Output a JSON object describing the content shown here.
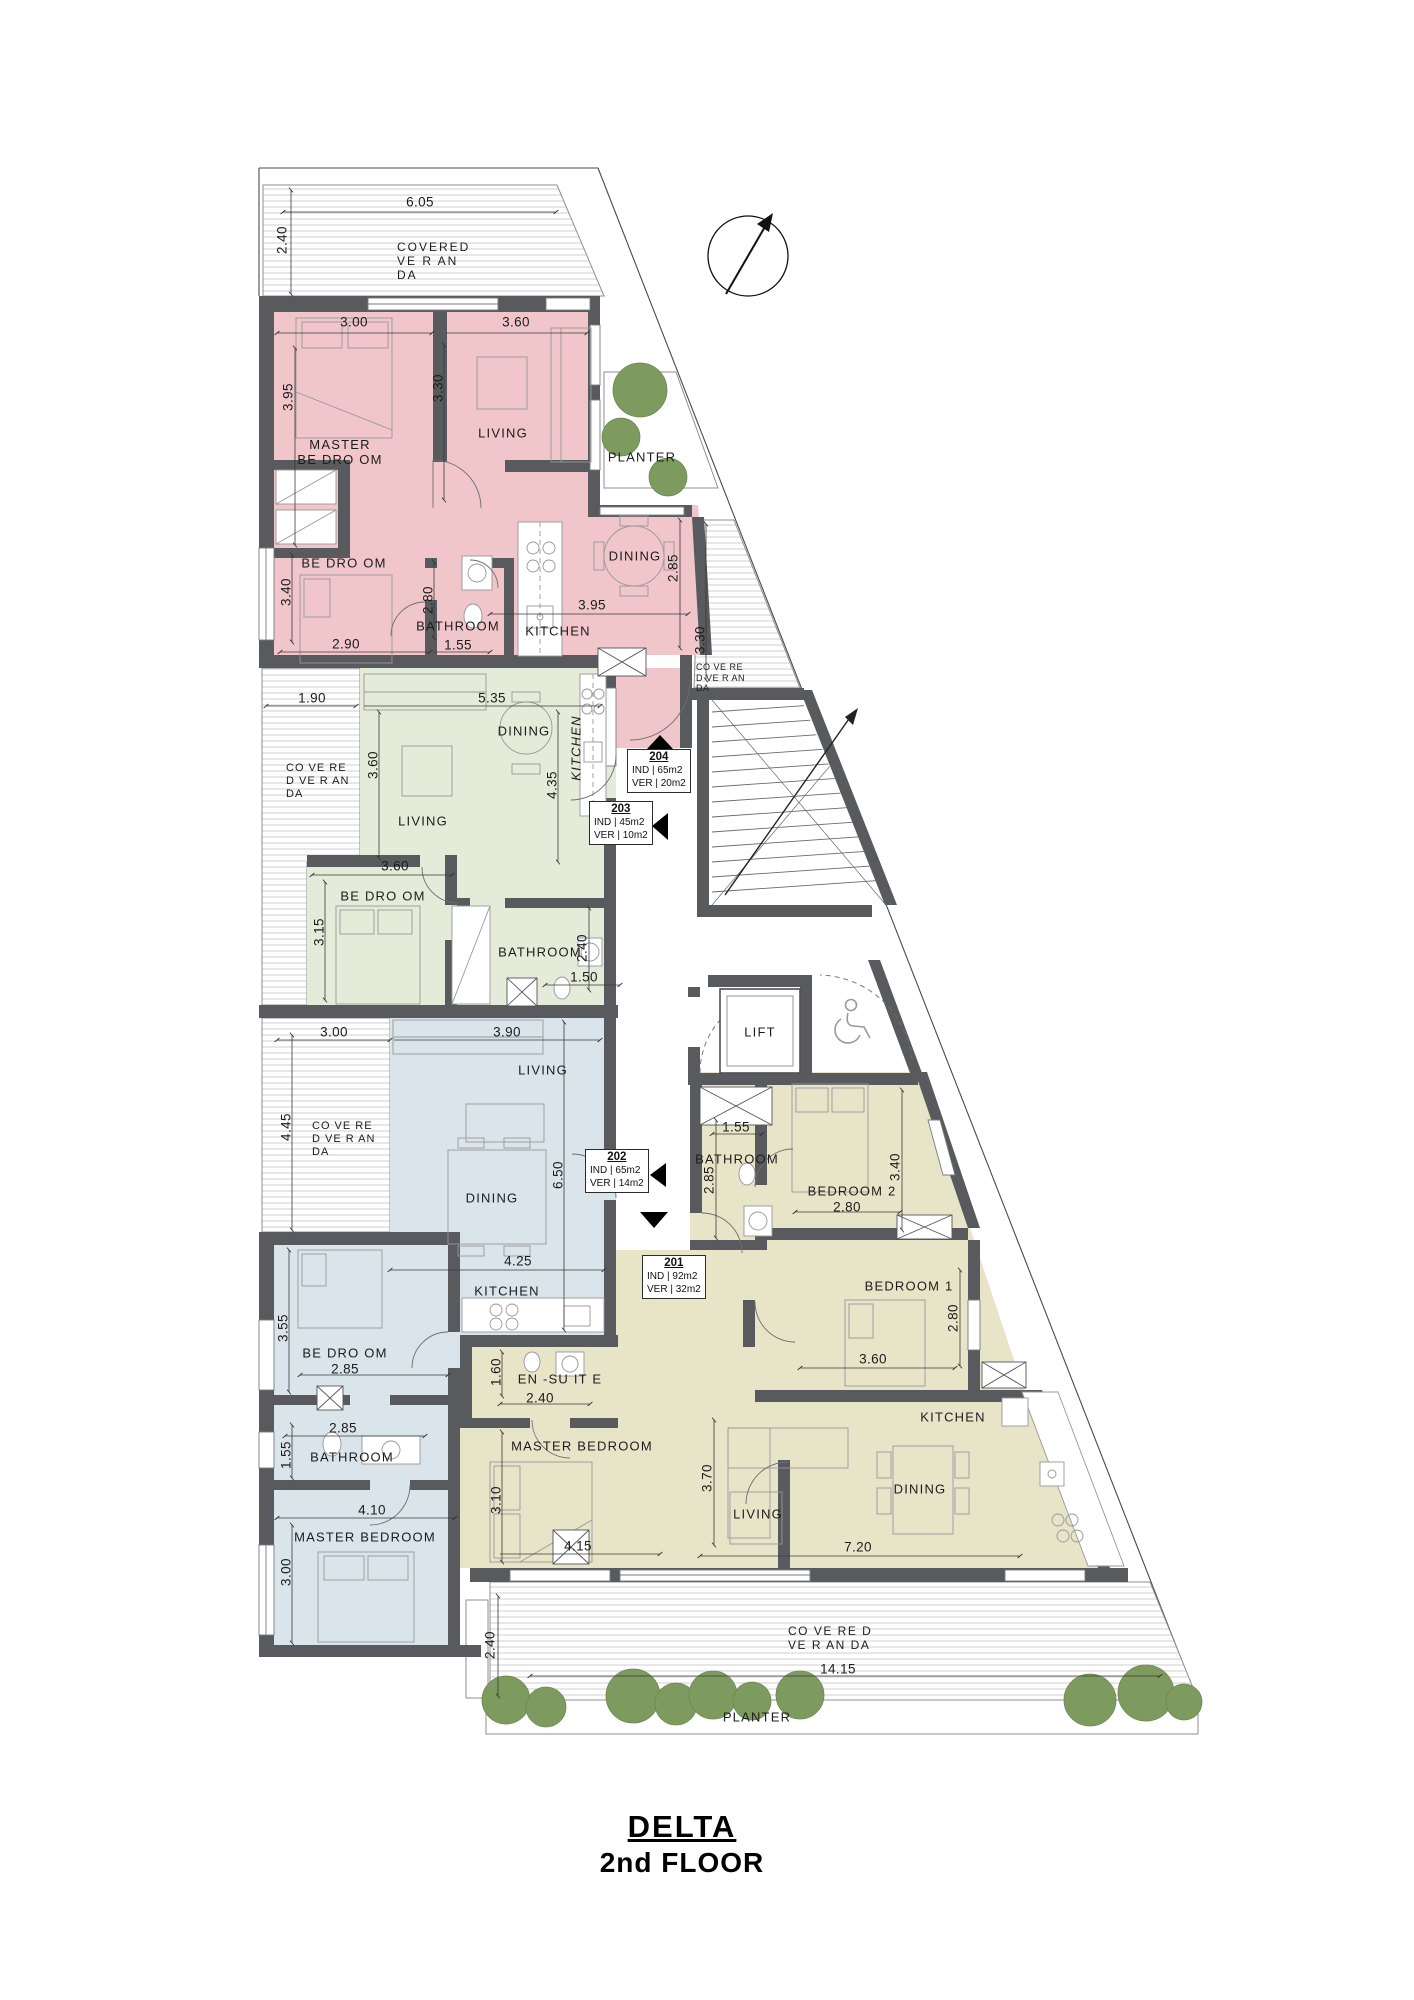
{
  "title": {
    "project": "DELTA",
    "floor": "2nd FLOOR"
  },
  "site": {
    "veranda_top": {
      "l1": "COVERED",
      "l2": "VE  R  AN",
      "l3": "DA",
      "width": "6.05",
      "depth": "2.40"
    },
    "veranda_right": {
      "l1": "CO VE RE",
      "l2": "D VE R AN",
      "l3": "DA",
      "depth": "3.30"
    },
    "veranda_bottom": {
      "l1": "CO VE RE D",
      "l2": "VE R AN DA",
      "width": "14.15",
      "depth": "2.40"
    },
    "planter_top": "PLANTER",
    "planter_bottom": "PLANTER",
    "lift": "LIFT"
  },
  "u204": {
    "number": "204",
    "ind": "IND | 65m2",
    "ver": "VER | 20m2",
    "master_l1": "MASTER",
    "master_l2": "BE DRO OM",
    "living": "LIVING",
    "bedroom": "BE DRO OM",
    "bathroom": "BATHROOM",
    "kitchen": "KITCHEN",
    "dining": "DINING",
    "dims": {
      "master_w": "3.00",
      "living_w": "3.60",
      "master_h": "3.95",
      "living_h": "3.30",
      "bedroom_h": "3.40",
      "bedroom_w": "2.90",
      "bath_h": "2.80",
      "bath_w": "1.55",
      "kitchen_w": "3.95",
      "dining_h": "2.85"
    }
  },
  "u203": {
    "number": "203",
    "ind": "IND | 45m2",
    "ver": "VER | 10m2",
    "veranda_l1": "CO  VE  RE",
    "veranda_l2": "D VE R AN",
    "veranda_l3": "DA",
    "living": "LIVING",
    "dining": "DINING",
    "kitchen": "KITCHEN",
    "bedroom": "BE DRO OM",
    "bathroom": "BATHROOM",
    "dims": {
      "veranda_w": "1.90",
      "living_w": "5.35",
      "living_h": "3.60",
      "kitchen_h": "4.35",
      "bedroom_w": "3.60",
      "bedroom_h": "3.15",
      "bath_h": "2.40",
      "bath_w": "1.50"
    }
  },
  "u202": {
    "number": "202",
    "ind": "IND | 65m2",
    "ver": "VER | 14m2",
    "veranda_l1": "CO  VE  RE",
    "veranda_l2": "D VE R AN",
    "veranda_l3": "DA",
    "living": "LIVING",
    "dining": "DINING",
    "kitchen": "KITCHEN",
    "bedroom": "BE DRO OM",
    "bathroom": "BATHROOM",
    "master": "MASTER BEDROOM",
    "dims": {
      "veranda_w": "3.00",
      "living_w": "3.90",
      "veranda_h": "4.45",
      "dining_h": "6.50",
      "kitchen_w": "4.25",
      "bedroom_h": "3.55",
      "bedroom_w": "2.85",
      "hall_w": "2.85",
      "bath_h": "1.55",
      "master_w": "4.10",
      "master_h": "3.00"
    }
  },
  "u201": {
    "number": "201",
    "ind": "IND | 92m2",
    "ver": "VER | 32m2",
    "bedroom2": "BEDROOM 2",
    "bedroom1": "BEDROOM 1",
    "bathroom": "BATHROOM",
    "ensuite": "EN -SU IT E",
    "master": "MASTER BEDROOM",
    "living": "LIVING",
    "dining": "DINING",
    "kitchen": "KITCHEN",
    "dims": {
      "bath_w": "1.55",
      "bath_h": "2.85",
      "bedroom2_w": "2.80",
      "bedroom2_h": "3.40",
      "bedroom1_h": "2.80",
      "bedroom1_w": "3.60",
      "ensuite_w": "2.40",
      "ensuite_h": "1.60",
      "master_w": "4.15",
      "master_h": "3.10",
      "living_h": "3.70",
      "dining_w": "7.20"
    }
  },
  "colors": {
    "unit_204": "#f1c6ca",
    "unit_203": "#e4ecd9",
    "unit_202": "#d9e5ea",
    "unit_201": "#e8e4c8",
    "wall": "#595a5e",
    "tree": "#7e9b5f"
  }
}
